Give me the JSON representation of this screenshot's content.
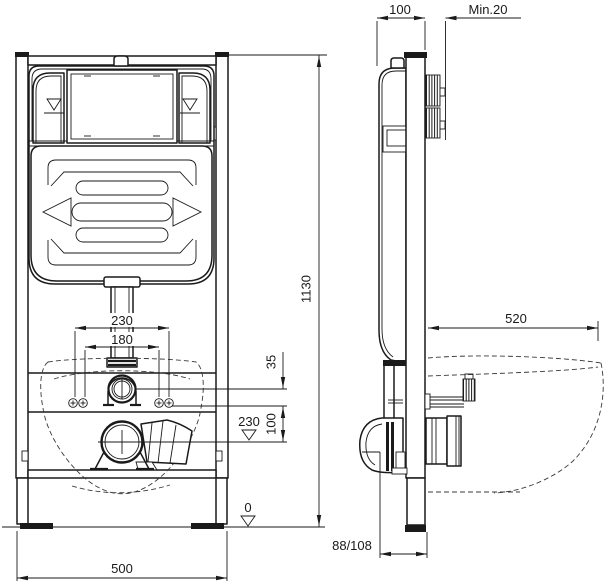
{
  "drawing": {
    "type": "technical-installation-drawing",
    "views": {
      "front": "wc-frame-front-view",
      "side": "wc-frame-side-view"
    }
  },
  "dimensions": {
    "frame_depth": "100",
    "wall_clearance": "Min.20",
    "frame_height": "1130",
    "bowl_depth": "520",
    "fixing_outer": "230",
    "fixing_inner": "180",
    "inlet_offset": "35",
    "inlet_drain_gap": "100",
    "drain_height": "230",
    "floor_level": "0",
    "frame_width": "500",
    "outlet_offset": "88/108"
  }
}
